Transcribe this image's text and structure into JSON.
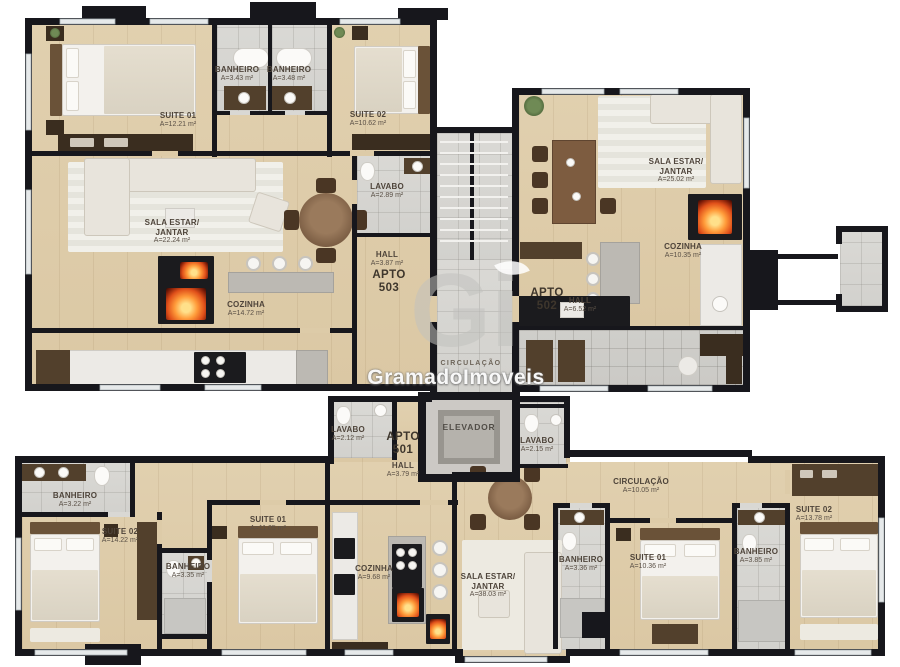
{
  "palette": {
    "wall": "#17171c",
    "wood": "#ddcba8",
    "tile": "#d6d5d1",
    "fire": "#e0501a"
  },
  "watermark": {
    "logo": "Gi",
    "brand": "GramadoImoveis"
  },
  "core": {
    "circulacao_center": "CIRCULAÇÃO",
    "elevador": "ELEVADOR"
  },
  "apto503": {
    "title": "APTO",
    "number": "503",
    "suite01": {
      "name": "SUITE 01",
      "area": "A=12.21 m²"
    },
    "banheiro_a": {
      "name": "BANHEIRO",
      "area": "A=3.43 m²"
    },
    "banheiro_b": {
      "name": "BANHEIRO",
      "area": "A=3.48 m²"
    },
    "suite02": {
      "name": "SUITE 02",
      "area": "A=10.62 m²"
    },
    "sala": {
      "name": "SALA ESTAR/",
      "name2": "JANTAR",
      "area": "A=22.24 m²"
    },
    "lavabo": {
      "name": "LAVABO",
      "area": "A=2.89 m²"
    },
    "hall": {
      "name": "HALL",
      "area": "A=3.87 m²"
    },
    "cozinha": {
      "name": "COZINHA",
      "area": "A=14.72 m²"
    }
  },
  "apto502": {
    "title": "APTO",
    "number": "502",
    "sala": {
      "name": "SALA ESTAR/",
      "name2": "JANTAR",
      "area": "A=25.02 m²"
    },
    "cozinha": {
      "name": "COZINHA",
      "area": "A=10.35 m²"
    },
    "hall": {
      "name": "HALL",
      "area": "A=6.52 m²"
    }
  },
  "apto501": {
    "title": "APTO",
    "number": "501",
    "hall": {
      "name": "HALL",
      "area": "A=3.79 m²"
    },
    "lavabo_esq": {
      "name": "LAVABO",
      "area": "A=2.12 m²"
    },
    "lavabo_dir": {
      "name": "LAVABO",
      "area": "A=2.15 m²"
    },
    "banheiro_noroeste": {
      "name": "BANHEIRO",
      "area": "A=3.22 m²"
    },
    "suite02_esq": {
      "name": "SUITE 02",
      "area": "A=14.22 m²"
    },
    "suite01_esq": {
      "name": "SUITE 01",
      "area": "A=11.05 m²"
    },
    "banheiro_central": {
      "name": "BANHEIRO",
      "area": "A=3.35 m²"
    },
    "cozinha": {
      "name": "COZINHA",
      "area": "A=9.68 m²"
    },
    "sala": {
      "name": "SALA ESTAR/",
      "name2": "JANTAR",
      "area": "A=38.03 m²"
    },
    "circulacao": {
      "name": "CIRCULAÇÃO",
      "area": "A=10.05 m²"
    },
    "banheiro_dir1": {
      "name": "BANHEIRO",
      "area": "A=3.36 m²"
    },
    "suite01_dir": {
      "name": "SUITE 01",
      "area": "A=10.36 m²"
    },
    "banheiro_dir2": {
      "name": "BANHEIRO",
      "area": "A=3.85 m²"
    },
    "suite02_dir": {
      "name": "SUITE 02",
      "area": "A=13.78 m²"
    }
  }
}
